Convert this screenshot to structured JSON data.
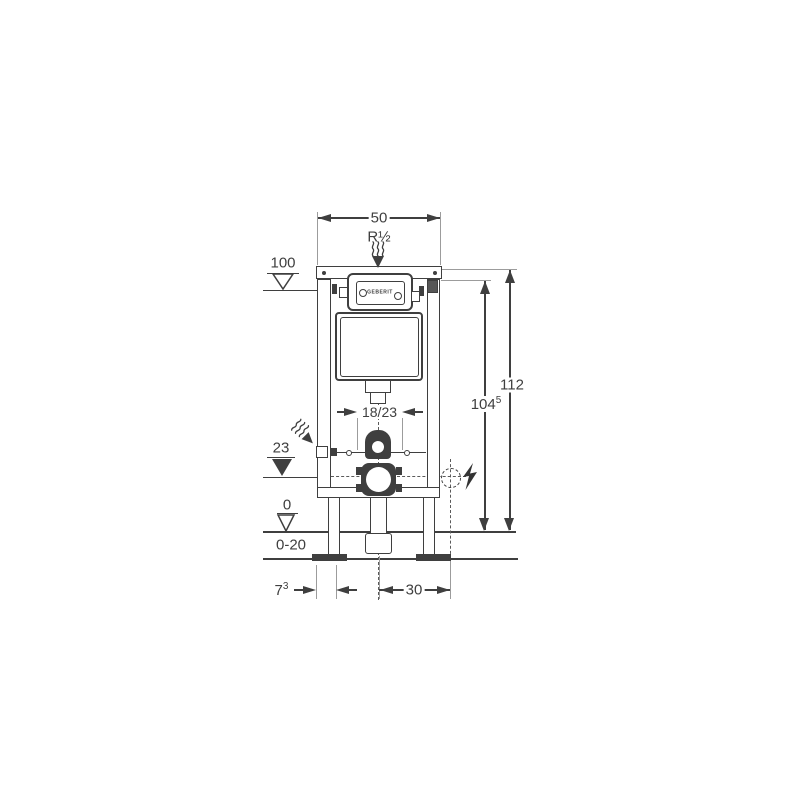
{
  "diagram": {
    "type": "installation-dimension-drawing",
    "subject": "concealed cistern wall frame",
    "brand": "GEBERIT",
    "units": "cm",
    "colors": {
      "line": "#3f3f3f",
      "thin_line": "#9c9c9c",
      "background": "#ffffff"
    }
  },
  "labels": {
    "top_width": "50",
    "inlet_thread": "R½",
    "upper_level": "100",
    "total_height": "112",
    "plate_height_base": "104",
    "plate_height_sup": "5",
    "rod_spacing": "18/23",
    "outlet_height": "23",
    "zero_level": "0",
    "floor_adjust_range": "0-20",
    "foot_depth_base": "7",
    "foot_depth_sup": "3",
    "outlet_offset": "30",
    "brand": "GEBERIT"
  }
}
